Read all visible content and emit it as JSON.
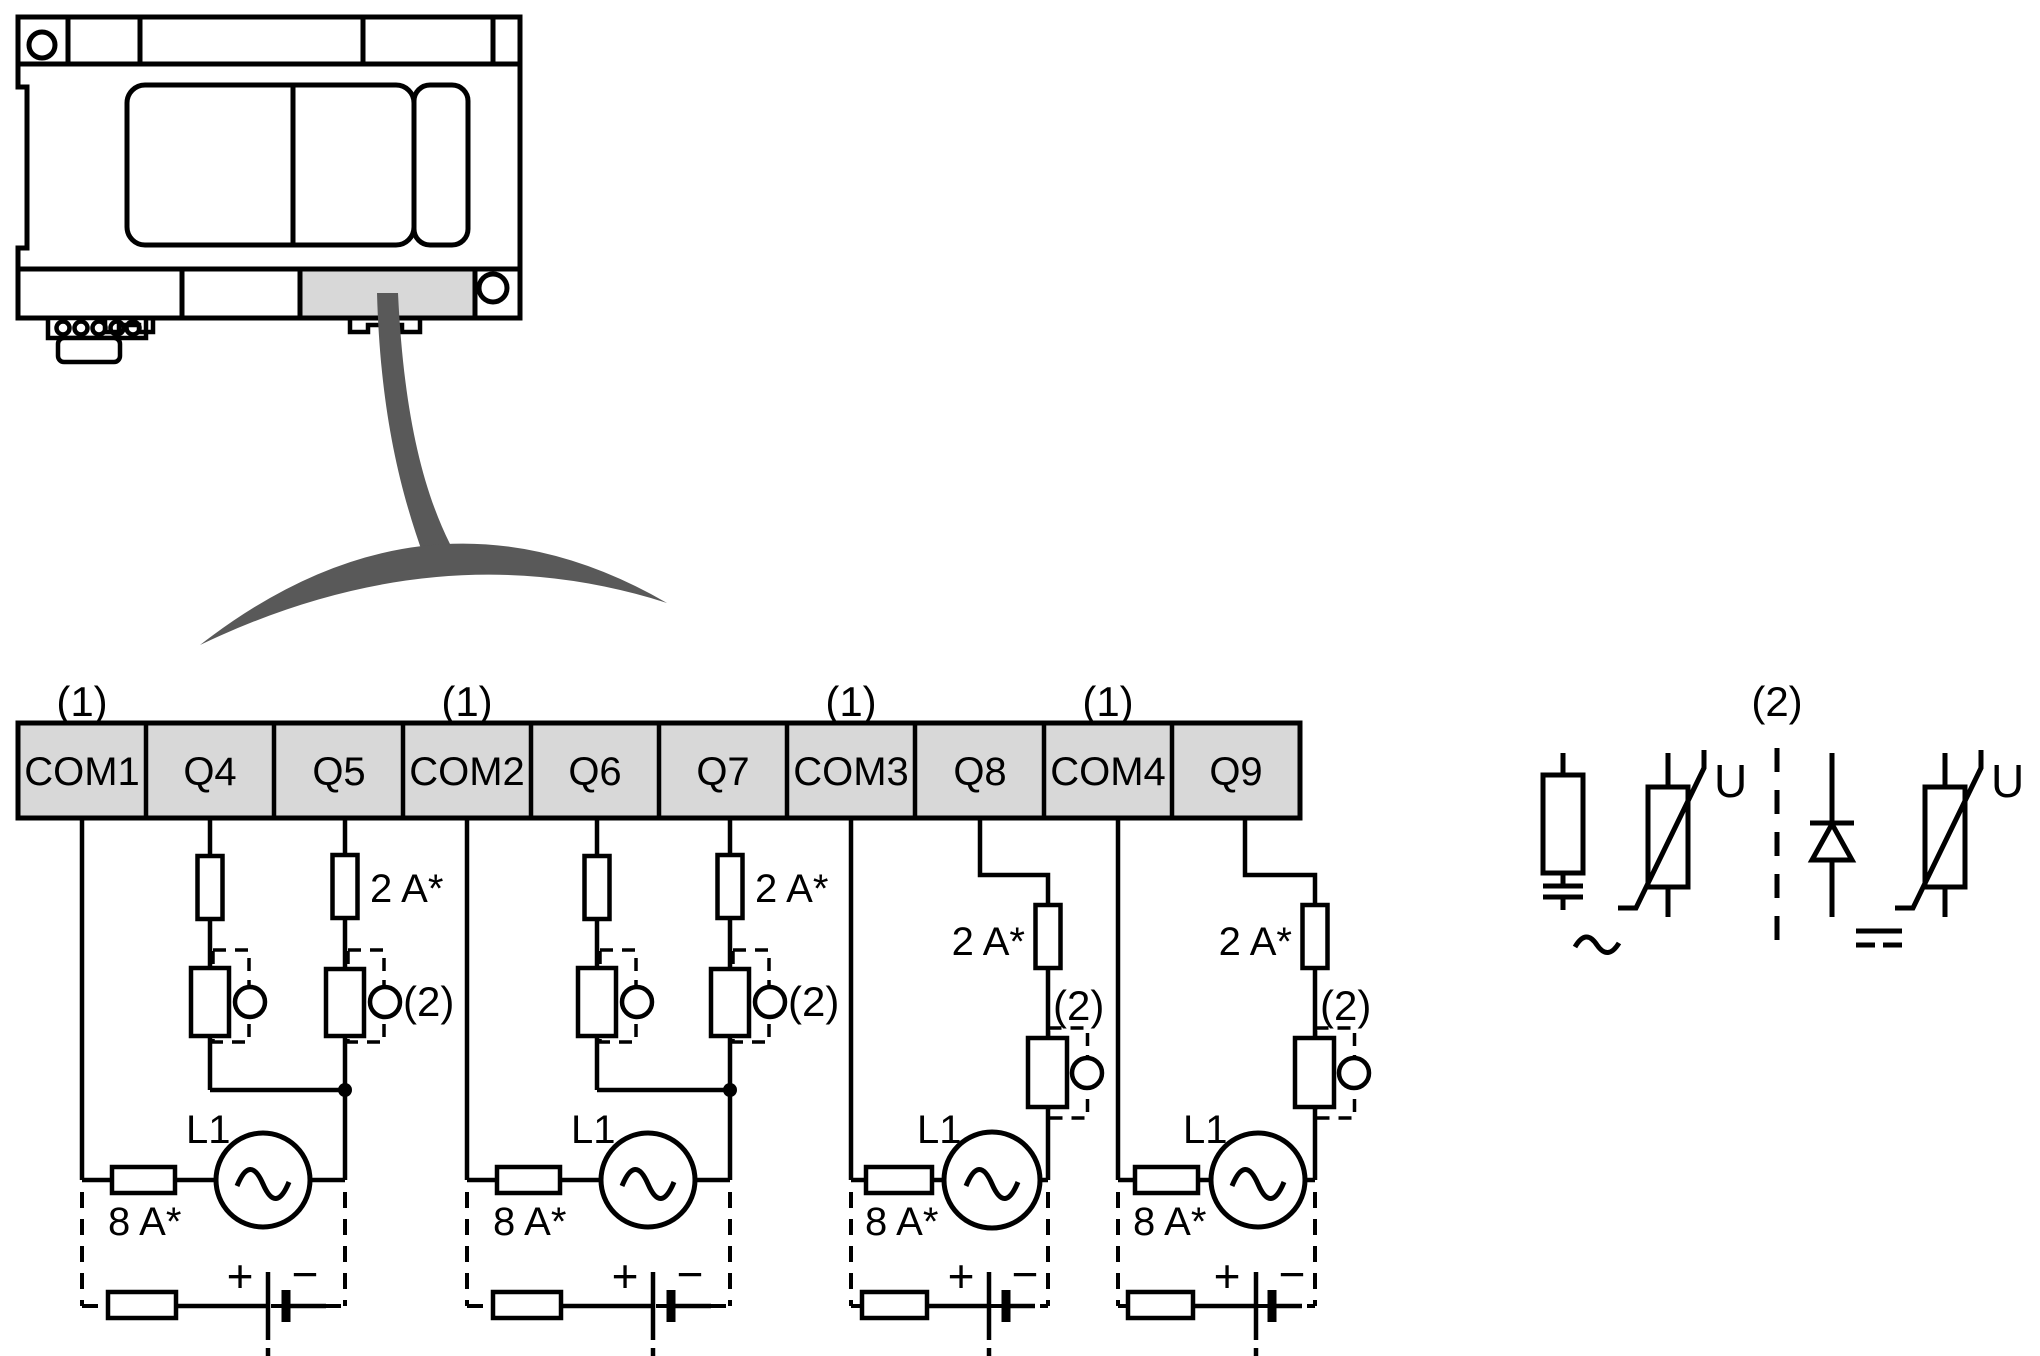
{
  "diagram_type": "plc-relay-output-wiring",
  "colors": {
    "ink": "#000000",
    "terminal_fill": "#d8d8d8",
    "device_highlight_fill": "#d8d8d8",
    "swoosh_arrow": "#595959",
    "background": "#ffffff"
  },
  "terminals": [
    "COM1",
    "Q4",
    "Q5",
    "COM2",
    "Q6",
    "Q7",
    "COM3",
    "Q8",
    "COM4",
    "Q9"
  ],
  "labels": {
    "note1": "(1)",
    "note2": "(2)",
    "output_fuse": "2 A*",
    "common_fuse": "8 A*",
    "lamp": "L1",
    "plus": "+",
    "minus": "−"
  },
  "legend": {
    "title": "(2)",
    "voltage_ac": "U",
    "voltage_dc": "U"
  }
}
